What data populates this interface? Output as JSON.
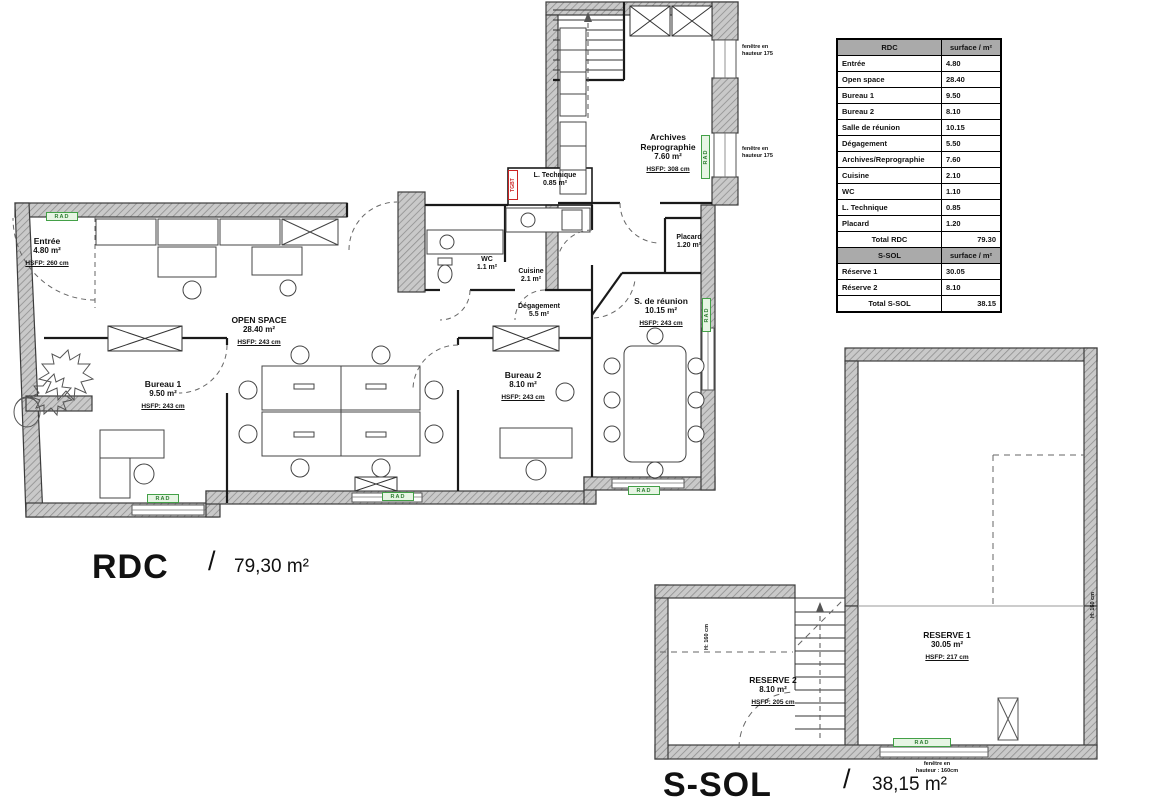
{
  "table": {
    "rdc_header": {
      "col1": "RDC",
      "col2": "surface / m²"
    },
    "rdc_rows": [
      {
        "label": "Entrée",
        "value": "4.80"
      },
      {
        "label": "Open space",
        "value": "28.40"
      },
      {
        "label": "Bureau 1",
        "value": "9.50"
      },
      {
        "label": "Bureau 2",
        "value": "8.10"
      },
      {
        "label": "Salle de réunion",
        "value": "10.15"
      },
      {
        "label": "Dégagement",
        "value": "5.50"
      },
      {
        "label": "Archives/Reprographie",
        "value": "7.60"
      },
      {
        "label": "Cuisine",
        "value": "2.10"
      },
      {
        "label": "WC",
        "value": "1.10"
      },
      {
        "label": "L. Technique",
        "value": "0.85"
      },
      {
        "label": "Placard",
        "value": "1.20"
      }
    ],
    "rdc_total": {
      "label": "Total RDC",
      "value": "79.30"
    },
    "ssol_header": {
      "col1": "S-SOL",
      "col2": "surface / m²"
    },
    "ssol_rows": [
      {
        "label": "Réserve 1",
        "value": "30.05"
      },
      {
        "label": "Réserve 2",
        "value": "8.10"
      }
    ],
    "ssol_total": {
      "label": "Total S-SOL",
      "value": "38.15"
    }
  },
  "rdc_plan": {
    "title": "RDC",
    "separator": "/",
    "total_area": "79,30 m²",
    "rooms": {
      "entree": {
        "name": "Entrée",
        "area": "4.80 m²",
        "hsfp": "HSFP: 260 cm"
      },
      "open_space": {
        "name": "OPEN SPACE",
        "area": "28.40 m²",
        "hsfp": "HSFP: 243 cm"
      },
      "bureau1": {
        "name": "Bureau 1",
        "area": "9.50 m²",
        "hsfp": "HSFP: 243 cm"
      },
      "bureau2": {
        "name": "Bureau 2",
        "area": "8.10 m²",
        "hsfp": "HSFP: 243 cm"
      },
      "reunion": {
        "name": "S. de réunion",
        "area": "10.15 m²",
        "hsfp": "HSFP: 243 cm"
      },
      "degagement": {
        "name": "Dégagement",
        "area": "5.5 m²"
      },
      "archives": {
        "name_line1": "Archives",
        "name_line2": "Reprographie",
        "area": "7.60 m²",
        "hsfp": "HSFP: 308 cm"
      },
      "cuisine": {
        "name": "Cuisine",
        "area": "2.1 m²"
      },
      "wc": {
        "name": "WC",
        "area": "1.1 m²"
      },
      "l_technique": {
        "name": "L. Technique",
        "area": "0.85 m²"
      },
      "placard": {
        "name": "Placard",
        "area": "1.20 m²"
      }
    }
  },
  "ssol_plan": {
    "title": "S-SOL",
    "separator": "/",
    "total_area": "38,15 m²",
    "rooms": {
      "reserve1": {
        "name": "RESERVE 1",
        "area": "30.05 m²",
        "hsfp": "HSFP: 217 cm"
      },
      "reserve2": {
        "name": "RESERVE 2",
        "area": "8.10 m²",
        "hsfp": "HSFP: 205 cm"
      }
    }
  },
  "annotations": {
    "rad": "RAD",
    "tgbt": "TGBT",
    "fenetre_175": [
      "fenêtre en",
      "hauteur 175"
    ],
    "fenetre_160": [
      "fenêtre en",
      "hauteur : 160cm"
    ],
    "h160": "H: 160 cm"
  },
  "colors": {
    "rad_green": "#43a047",
    "tgbt_red": "#cc2222",
    "wall_gray": "#c9c9c9"
  }
}
